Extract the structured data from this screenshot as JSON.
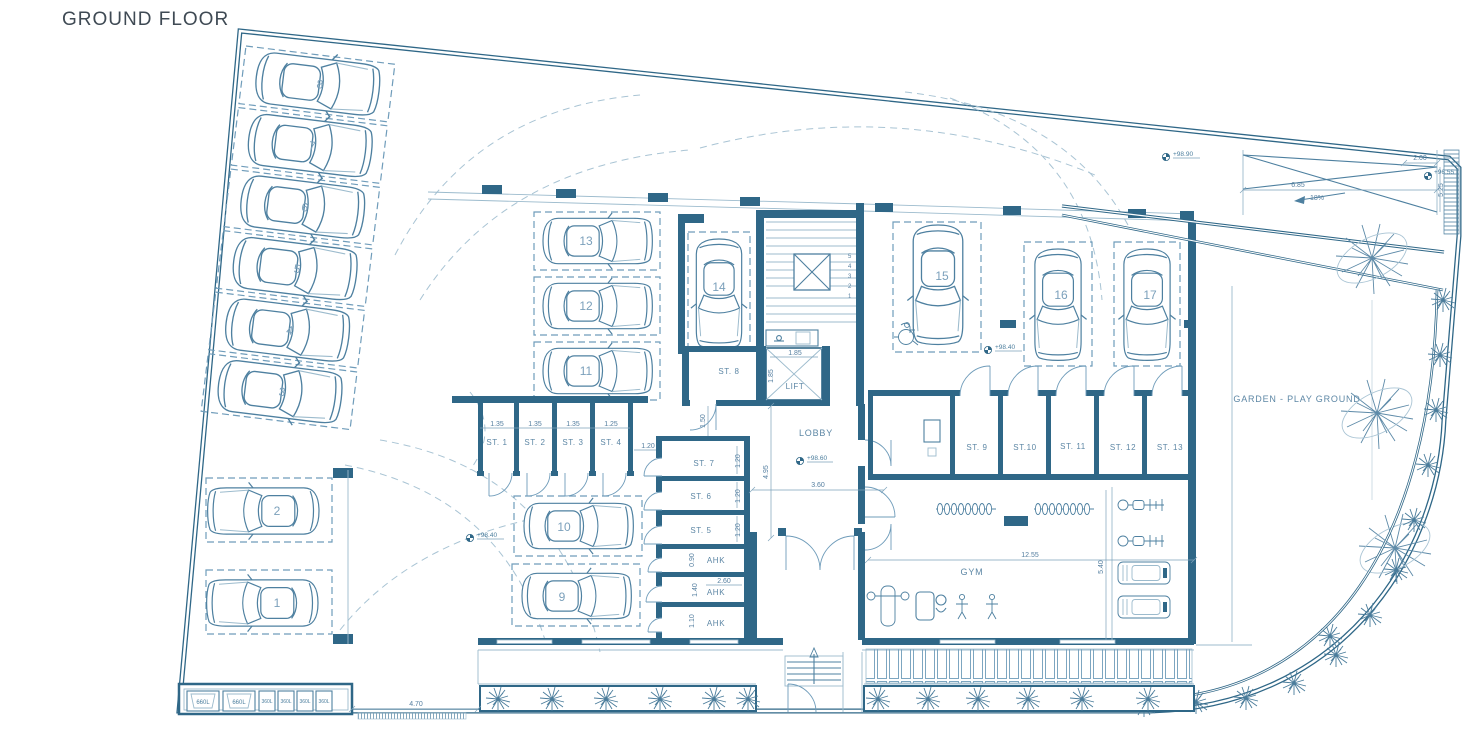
{
  "title": "GROUND FLOOR",
  "colors": {
    "wall": "#2f6787",
    "line": "#4e80a0",
    "light": "#9cbbcd",
    "dashed": "#6f9cba",
    "label": "#5d87a5",
    "title": "#3f4a54"
  },
  "parking": {
    "spaces": [
      {
        "label": "1"
      },
      {
        "label": "2"
      },
      {
        "label": "3"
      },
      {
        "label": "4"
      },
      {
        "label": "5"
      },
      {
        "label": "6"
      },
      {
        "label": "7"
      },
      {
        "label": "8"
      },
      {
        "label": "9"
      },
      {
        "label": "10"
      },
      {
        "label": "11"
      },
      {
        "label": "12"
      },
      {
        "label": "13"
      },
      {
        "label": "14"
      },
      {
        "label": "15"
      },
      {
        "label": "16"
      },
      {
        "label": "17"
      }
    ]
  },
  "storage": {
    "st1": "ST. 1",
    "st2": "ST. 2",
    "st3": "ST. 3",
    "st4": "ST. 4",
    "st5": "ST. 5",
    "st6": "ST. 6",
    "st7": "ST. 7",
    "st8": "ST. 8",
    "st9": "ST. 9",
    "st10": "ST.10",
    "st11": "ST. 11",
    "st12": "ST. 12",
    "st13": "ST. 13"
  },
  "rooms": {
    "lobby": "LOBBY",
    "lift": "LIFT",
    "gym": "GYM",
    "garden": "GARDEN - PLAY GROUND",
    "ahk1": "AHK",
    "ahk2": "AHK",
    "ahk3": "AHK"
  },
  "levels": {
    "ramp_top": "+98.90",
    "ramp_bottom": "+96.55",
    "lobby": "+98.60",
    "garage": "+98.40",
    "driveway": "+98.40"
  },
  "dims": {
    "st1_w": "1.35",
    "st2_w": "1.35",
    "st3_w": "1.35",
    "st4_w": "1.25",
    "aisle": "1.20",
    "st7_h": "1.20",
    "st6_h": "1.20",
    "st5_h": "1.20",
    "ahk1_h": "0.90",
    "ahk2_w": "2.60",
    "ahk2_h": "1.40",
    "ahk3_h": "1.10",
    "corridor": "1.50",
    "lobby_len": "4.95",
    "lobby_w": "3.60",
    "lift_w": "1.85",
    "lift_d": "1.85",
    "gym_w": "12.55",
    "gym_d": "5.40",
    "ramp_len": "6.85",
    "ramp_w": "2.00",
    "ramp_side": "5.25",
    "bin_front": "4.70",
    "slope": "18%"
  },
  "stairs": {
    "steps": [
      "5",
      "4",
      "3",
      "2",
      "1"
    ]
  },
  "bins": [
    {
      "label": "660L"
    },
    {
      "label": "660L"
    },
    {
      "label": "360L"
    },
    {
      "label": "360L"
    },
    {
      "label": "360L"
    },
    {
      "label": "360L"
    }
  ]
}
